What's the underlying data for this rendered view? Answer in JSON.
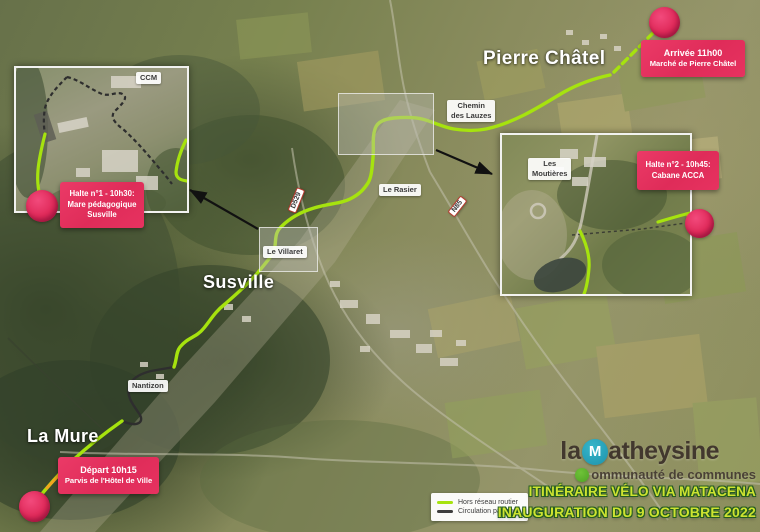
{
  "places": {
    "pierre_chatel": "Pierre Châtel",
    "susville": "Susville",
    "la_mure": "La Mure"
  },
  "chips": {
    "ccm": "CCM",
    "chemin_line1": "Chemin",
    "chemin_line2": "des Lauzes",
    "le_rasier": "Le Rasier",
    "le_villaret": "Le Villaret",
    "nantizon": "Nantizon",
    "moutieres_line1": "Les",
    "moutieres_line2": "Moutières"
  },
  "shields": {
    "d529": "D529",
    "n85": "N85"
  },
  "badges": {
    "arrivee": {
      "line1": "Arrivée 11h00",
      "line2": "Marché de Pierre Châtel"
    },
    "halte1": {
      "line1": "Halte n°1 - 10h30:",
      "line2": "Mare pédagogique",
      "line3": "Susville"
    },
    "halte2": {
      "line1": "Halte n°2 - 10h45:",
      "line2": "Cabane ACCA"
    },
    "depart": {
      "line1": "Départ 10h15",
      "line2": "Parvis de l'Hôtel de Ville"
    }
  },
  "legend": {
    "items": [
      {
        "label": "Hors réseau routier",
        "color": "#a6e30e"
      },
      {
        "label": "Circulation partagée",
        "color": "#3d3d3d"
      }
    ]
  },
  "title": {
    "line1": "ITINÉRAIRE VÉLO VIA MATACENA",
    "line2": "INAUGURATION DU 9 OCTOBRE 2022"
  },
  "logo": {
    "la": "la",
    "m": "M",
    "name_rest": "atheysine",
    "sub_rest": "ommunauté de communes"
  },
  "colors": {
    "route_offroad_green": "#a6e30e",
    "route_shared_dark": "#3d3d3d",
    "badge_pink": "#e63561",
    "marker_pink": "#e02a5a",
    "title_green": "#cde331",
    "logo_teal": "#2aa9bf",
    "logo_green": "#5fb32c"
  }
}
